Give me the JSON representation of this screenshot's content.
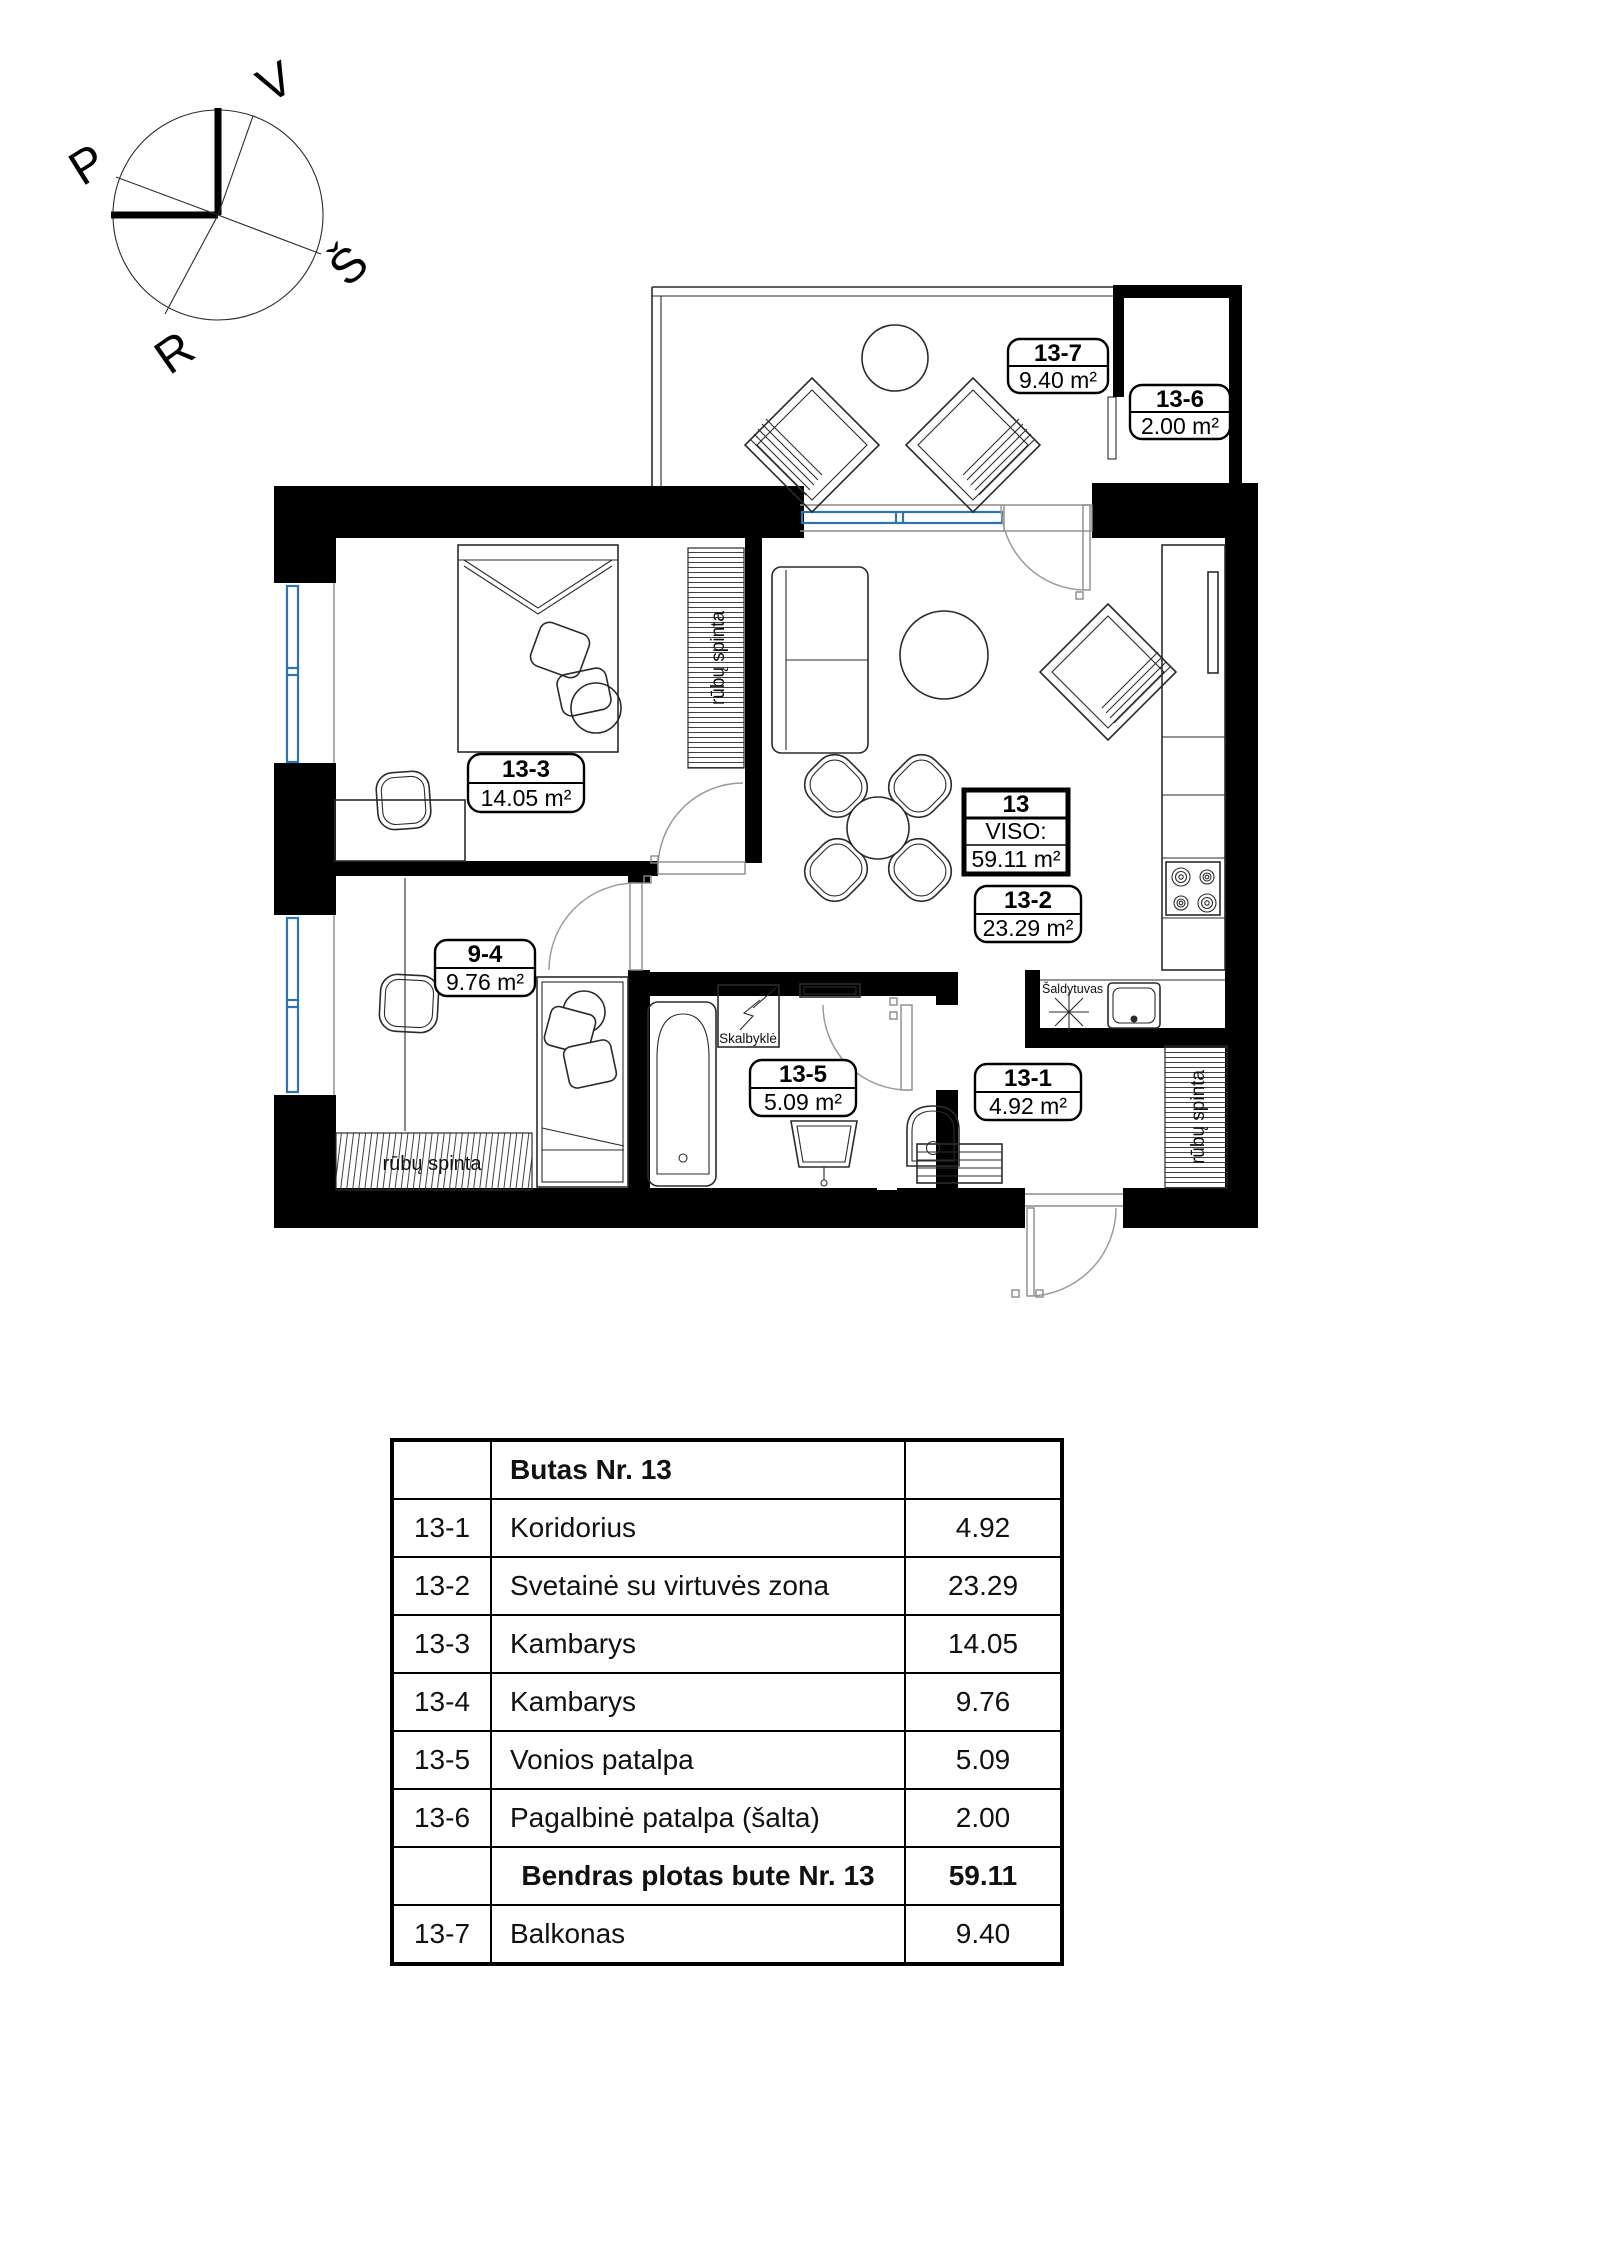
{
  "compass": {
    "letters": {
      "v": "V",
      "p": "P",
      "s": "Š",
      "r": "R"
    }
  },
  "plan": {
    "labels": [
      {
        "id": "13-7",
        "area": "9.40 m²"
      },
      {
        "id": "13-6",
        "area": "2.00 m²"
      },
      {
        "id": "13-3",
        "area": "14.05 m²"
      },
      {
        "id": "9-4",
        "area": "9.76 m²"
      },
      {
        "id": "13-2",
        "area": "23.29 m²"
      },
      {
        "id": "13-5",
        "area": "5.09 m²"
      },
      {
        "id": "13-1",
        "area": "4.92 m²"
      }
    ],
    "total_box": {
      "number": "13",
      "caption": "VISO:",
      "area": "59.11 m²"
    },
    "annotations": {
      "wardrobe_bedroom": "rūbų spinta",
      "wardrobe_room": "rūbų spinta",
      "wardrobe_hall": "rūbų spinta",
      "fridge": "Šaldytuvas",
      "washer": "Skalbyklė"
    },
    "colors": {
      "wall": "#000000",
      "window": "#2e74b5",
      "door_arc": "#9b9b9b"
    }
  },
  "table": {
    "title": "Butas Nr. 13",
    "rows": [
      {
        "id": "13-1",
        "name": "Koridorius",
        "value": "4.92"
      },
      {
        "id": "13-2",
        "name": "Svetainė su virtuvės  zona",
        "value": "23.29"
      },
      {
        "id": "13-3",
        "name": "Kambarys",
        "value": "14.05"
      },
      {
        "id": "13-4",
        "name": "Kambarys",
        "value": "9.76"
      },
      {
        "id": "13-5",
        "name": "Vonios patalpa",
        "value": "5.09"
      },
      {
        "id": "13-6",
        "name": "Pagalbinė patalpa (šalta)",
        "value": "2.00"
      },
      {
        "id": "",
        "name": "Bendras plotas  bute Nr. 13",
        "value": "59.11"
      },
      {
        "id": "13-7",
        "name": "Balkonas",
        "value": "9.40"
      }
    ]
  }
}
